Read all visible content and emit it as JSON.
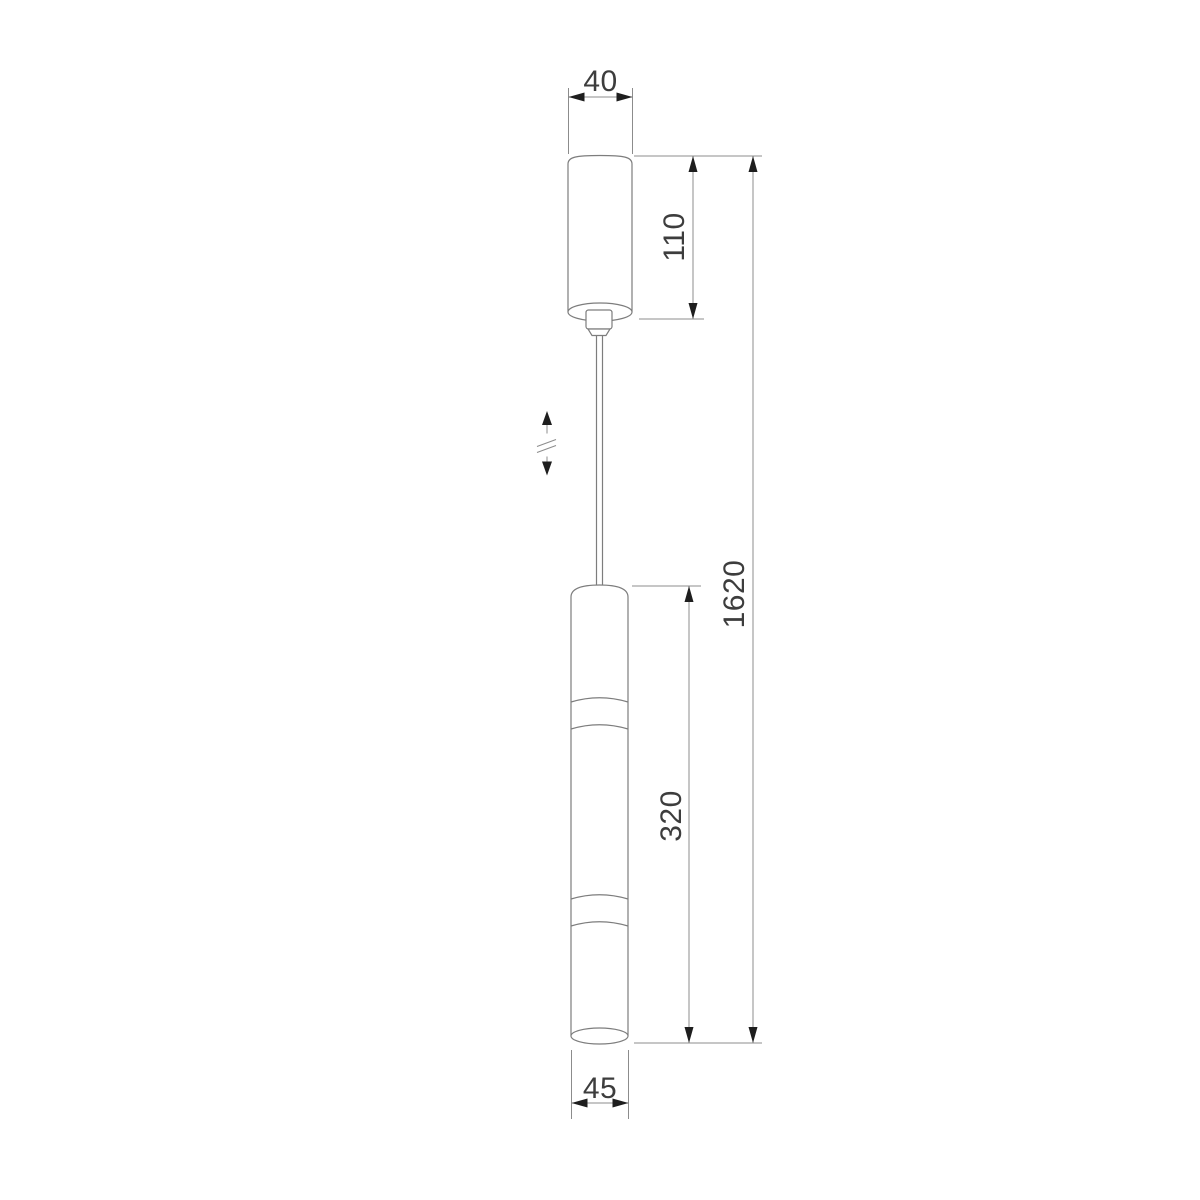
{
  "drawing": {
    "description": "Pendant lamp technical dimension drawing",
    "labels": {
      "canopy_width": "40",
      "canopy_height": "110",
      "overall_height": "1620",
      "body_height": "320",
      "body_diameter": "45"
    },
    "colors": {
      "background": "#ffffff",
      "outline": "#7d7d7d",
      "dimension_line": "#8c8c8c",
      "arrowhead": "#1e1e1e",
      "label_text": "#3d3d3d"
    },
    "symbols": {
      "height_adjustment": "vertical double arrow with break marks (adjustable suspension height)"
    }
  }
}
